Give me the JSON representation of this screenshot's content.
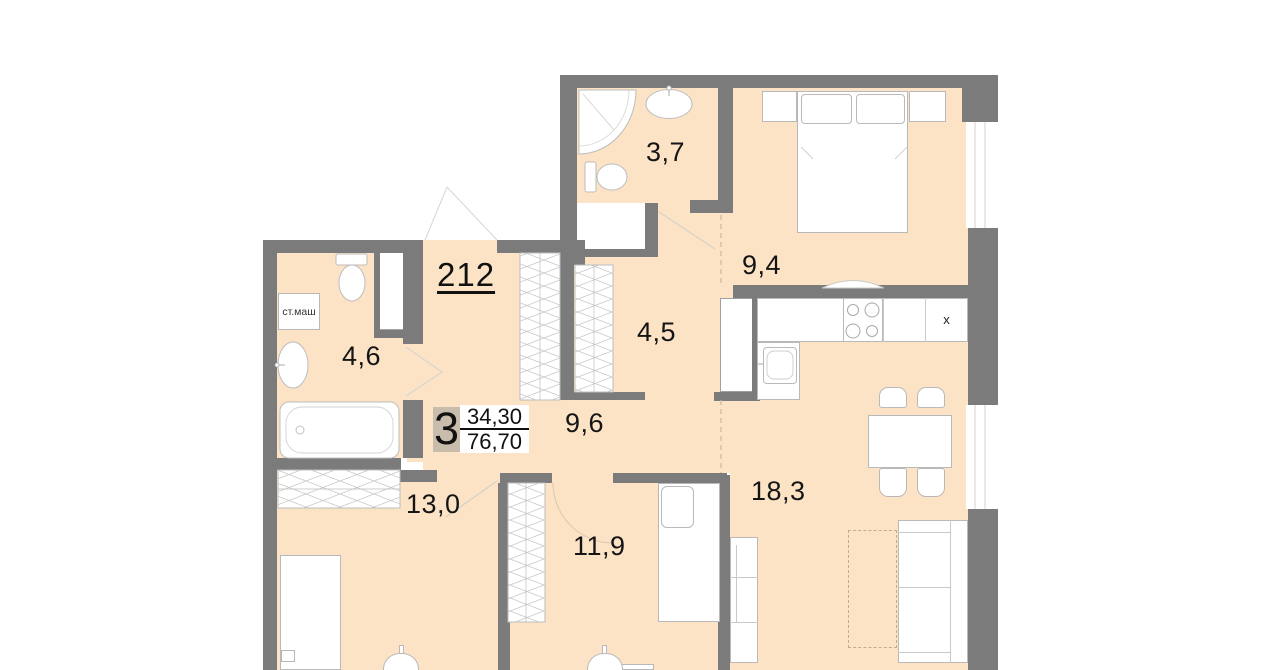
{
  "apartment": {
    "number": "212",
    "rooms_count": "3",
    "living_area": "34,30",
    "total_area": "76,70"
  },
  "rooms": [
    {
      "id": "bathroom-top",
      "label": "3,7"
    },
    {
      "id": "bedroom-top",
      "label": "9,4"
    },
    {
      "id": "bathroom-left",
      "label": "4,6"
    },
    {
      "id": "hallway",
      "label": "4,5"
    },
    {
      "id": "corridor",
      "label": "9,6"
    },
    {
      "id": "bedroom-left",
      "label": "13,0"
    },
    {
      "id": "bedroom-middle",
      "label": "11,9"
    },
    {
      "id": "kitchen-living",
      "label": "18,3"
    }
  ],
  "annotations": {
    "washing_machine": "ст.маш",
    "kitchen_unit": "x"
  },
  "colors": {
    "floor": "#fce3c5",
    "wall": "#7b7b7b",
    "rooms_count_badge": "#c8bdac"
  }
}
